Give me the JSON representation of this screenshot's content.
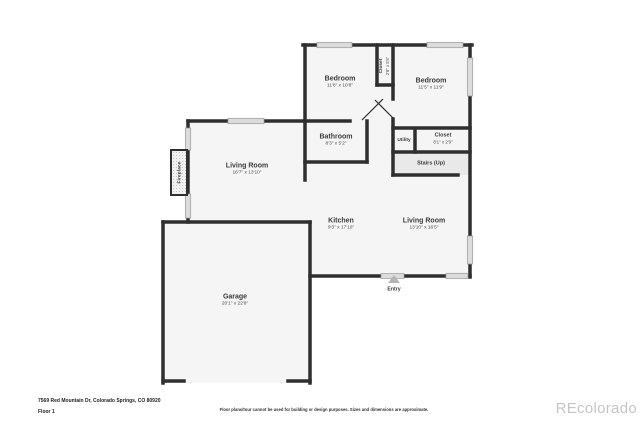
{
  "floorplan": {
    "rooms": {
      "bedroom_left": {
        "label": "Bedroom",
        "dims": "11'8\" x 10'8\""
      },
      "bedroom_right": {
        "label": "Bedroom",
        "dims": "11'5\" x 11'9\""
      },
      "bedroom_closet": {
        "label": "Closet",
        "dims": "2'8\" x 5'5\""
      },
      "bathroom": {
        "label": "Bathroom",
        "dims": "8'3\" x 5'2\""
      },
      "utility": {
        "label": "Utility"
      },
      "hall_closet": {
        "label": "Closet",
        "dims": "8'1\" x 2'9\""
      },
      "stairs": {
        "label": "Stairs (Up)"
      },
      "living_room_left": {
        "label": "Living Room",
        "dims": "16'7\" x 13'10\""
      },
      "kitchen": {
        "label": "Kitchen",
        "dims": "9'3\" x 17'10\""
      },
      "living_room_right": {
        "label": "Living Room",
        "dims": "13'10\" x 16'5\""
      },
      "garage": {
        "label": "Garage",
        "dims": "20'1\" x 22'8\""
      },
      "fireplace": {
        "label": "Fireplace"
      },
      "entry": {
        "label": "Entry"
      }
    },
    "colors": {
      "wall": "#2f2f2f",
      "room_fill": "#f5f5f5",
      "stairs_fill": "#e9e9e9",
      "window": "#dcdcdc",
      "text": "#3b3b3b",
      "watermark": "#c5c5c5"
    }
  },
  "footer": {
    "address": "7569 Red Mountain Dr, Colorado Springs, CO 80920",
    "floor": "Floor 1",
    "disclaimer": "Floor plans/tour cannot be used for building or design purposes. Sizes and dimensions are approximate.",
    "watermark": "REcolorado"
  }
}
